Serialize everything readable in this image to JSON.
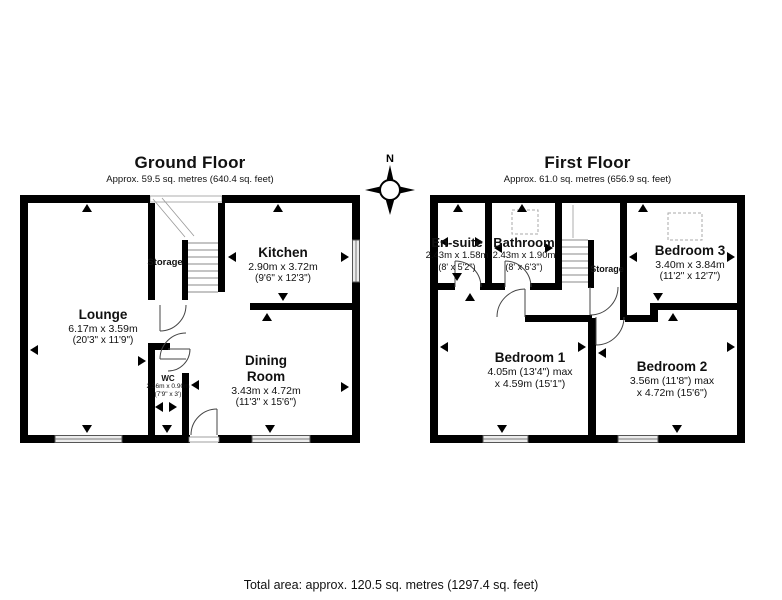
{
  "footer": {
    "total_area": "Total area: approx. 120.5 sq. metres (1297.4 sq. feet)"
  },
  "compass": {
    "north_label": "N"
  },
  "colors": {
    "wall": "#000000",
    "window_fill": "#ececec",
    "stair_line": "#888888",
    "door_arc": "#444444"
  },
  "ground_floor": {
    "title": "Ground Floor",
    "subtitle": "Approx. 59.5 sq. metres (640.4 sq. feet)",
    "rooms": {
      "lounge": {
        "name": "Lounge",
        "metric": "6.17m x 3.59m",
        "imperial": "(20'3\" x 11'9\")"
      },
      "kitchen": {
        "name": "Kitchen",
        "metric": "2.90m x 3.72m",
        "imperial": "(9'6\" x 12'3\")"
      },
      "dining_room": {
        "name": "Dining Room",
        "metric": "3.43m x 4.72m",
        "imperial": "(11'3\" x 15'6\")"
      },
      "wc": {
        "name": "WC",
        "metric": "2.36m x 0.90m",
        "imperial": "(7'9\" x 3')"
      },
      "storage": {
        "name": "Storage"
      }
    }
  },
  "first_floor": {
    "title": "First Floor",
    "subtitle": "Approx. 61.0 sq. metres (656.9 sq. feet)",
    "rooms": {
      "en_suite": {
        "name": "En-suite",
        "metric": "2.43m x 1.58m",
        "imperial": "(8' x 5'2\")"
      },
      "bathroom": {
        "name": "Bathroom",
        "metric": "2.43m x 1.90m",
        "imperial": "(8' x 6'3\")"
      },
      "bedroom_3": {
        "name": "Bedroom 3",
        "metric": "3.40m x 3.84m",
        "imperial": "(11'2\" x 12'7\")"
      },
      "bedroom_1": {
        "name": "Bedroom 1",
        "dim_line1": "4.05m (13'4\") max",
        "dim_line2": "x 4.59m (15'1\")"
      },
      "bedroom_2": {
        "name": "Bedroom 2",
        "dim_line1": "3.56m (11'8\") max",
        "dim_line2": "x 4.72m (15'6\")"
      },
      "storage": {
        "name": "Storage"
      }
    }
  }
}
